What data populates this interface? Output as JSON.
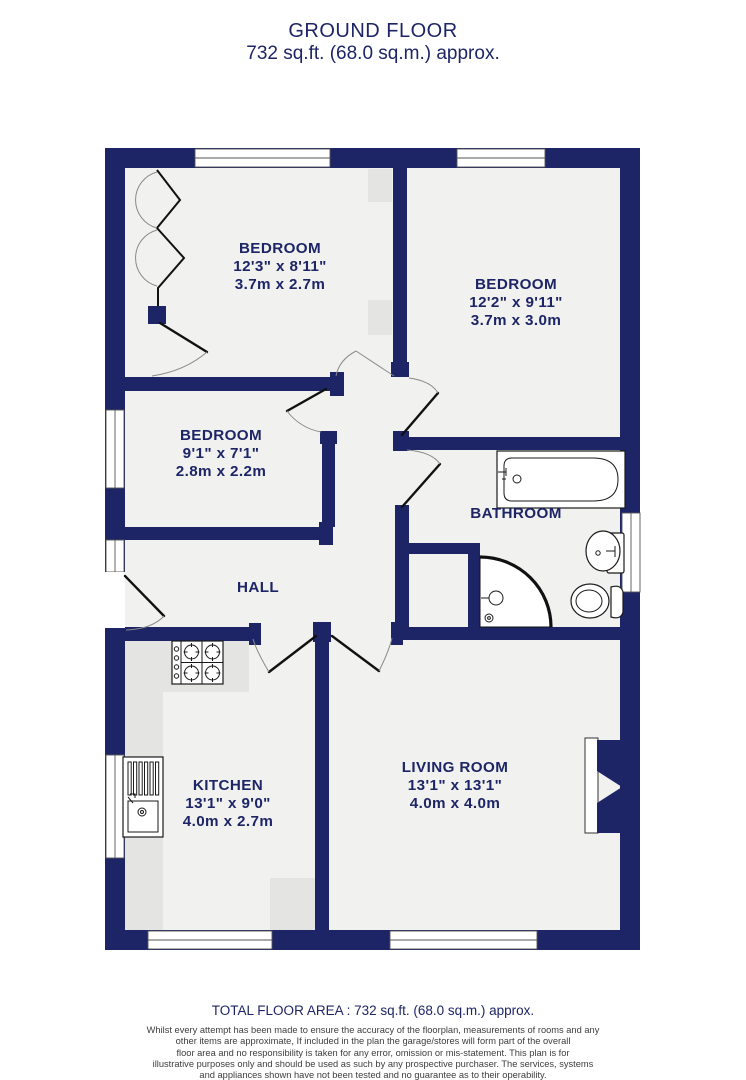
{
  "title": {
    "line1": "GROUND FLOOR",
    "line2": "732 sq.ft. (68.0 sq.m.) approx."
  },
  "rooms": [
    {
      "id": "bedroom-1",
      "name": "BEDROOM",
      "imperial": "12'3\" x 8'11\"",
      "metric": "3.7m x 2.7m"
    },
    {
      "id": "bedroom-2",
      "name": "BEDROOM",
      "imperial": "12'2\" x 9'11\"",
      "metric": "3.7m x 3.0m"
    },
    {
      "id": "bedroom-3",
      "name": "BEDROOM",
      "imperial": "9'1\" x 7'1\"",
      "metric": "2.8m x 2.2m"
    },
    {
      "id": "bathroom",
      "name": "BATHROOM"
    },
    {
      "id": "hall",
      "name": "HALL"
    },
    {
      "id": "kitchen",
      "name": "KITCHEN",
      "imperial": "13'1\" x 9'0\"",
      "metric": "4.0m x 2.7m"
    },
    {
      "id": "living-room",
      "name": "LIVING ROOM",
      "imperial": "13'1\" x 13'1\"",
      "metric": "4.0m x 4.0m"
    }
  ],
  "fixtures": [
    "bathtub",
    "washbasin",
    "toilet",
    "corner-shower",
    "gas-hob",
    "kitchen-sink-drainer",
    "bifold-wardrobe-doors",
    "chimney-breast"
  ],
  "footer": {
    "total_area": "TOTAL FLOOR AREA : 732 sq.ft. (68.0 sq.m.) approx.",
    "disclaimer": [
      "Whilst every attempt has been made to ensure the accuracy of the floorplan, measurements of rooms and any",
      "other items are approximate, If included in the plan the garage/stores will form part of the overall",
      "floor area and no responsibility is taken for any error, omission or mis-statement. This plan is for",
      "illustrative purposes only and should be used as such by any prospective purchaser. The services, systems",
      "and appliances shown have not been tested and no guarantee as to their operability."
    ],
    "credit": "Made with Metropix ©2025"
  },
  "colors": {
    "wall_navy": "#1d2566",
    "text_navy": "#1d2566",
    "floor": "#f1f1ef",
    "counter_gray": "#e4e4e2",
    "disclaimer_gray": "#3d3d3d"
  }
}
